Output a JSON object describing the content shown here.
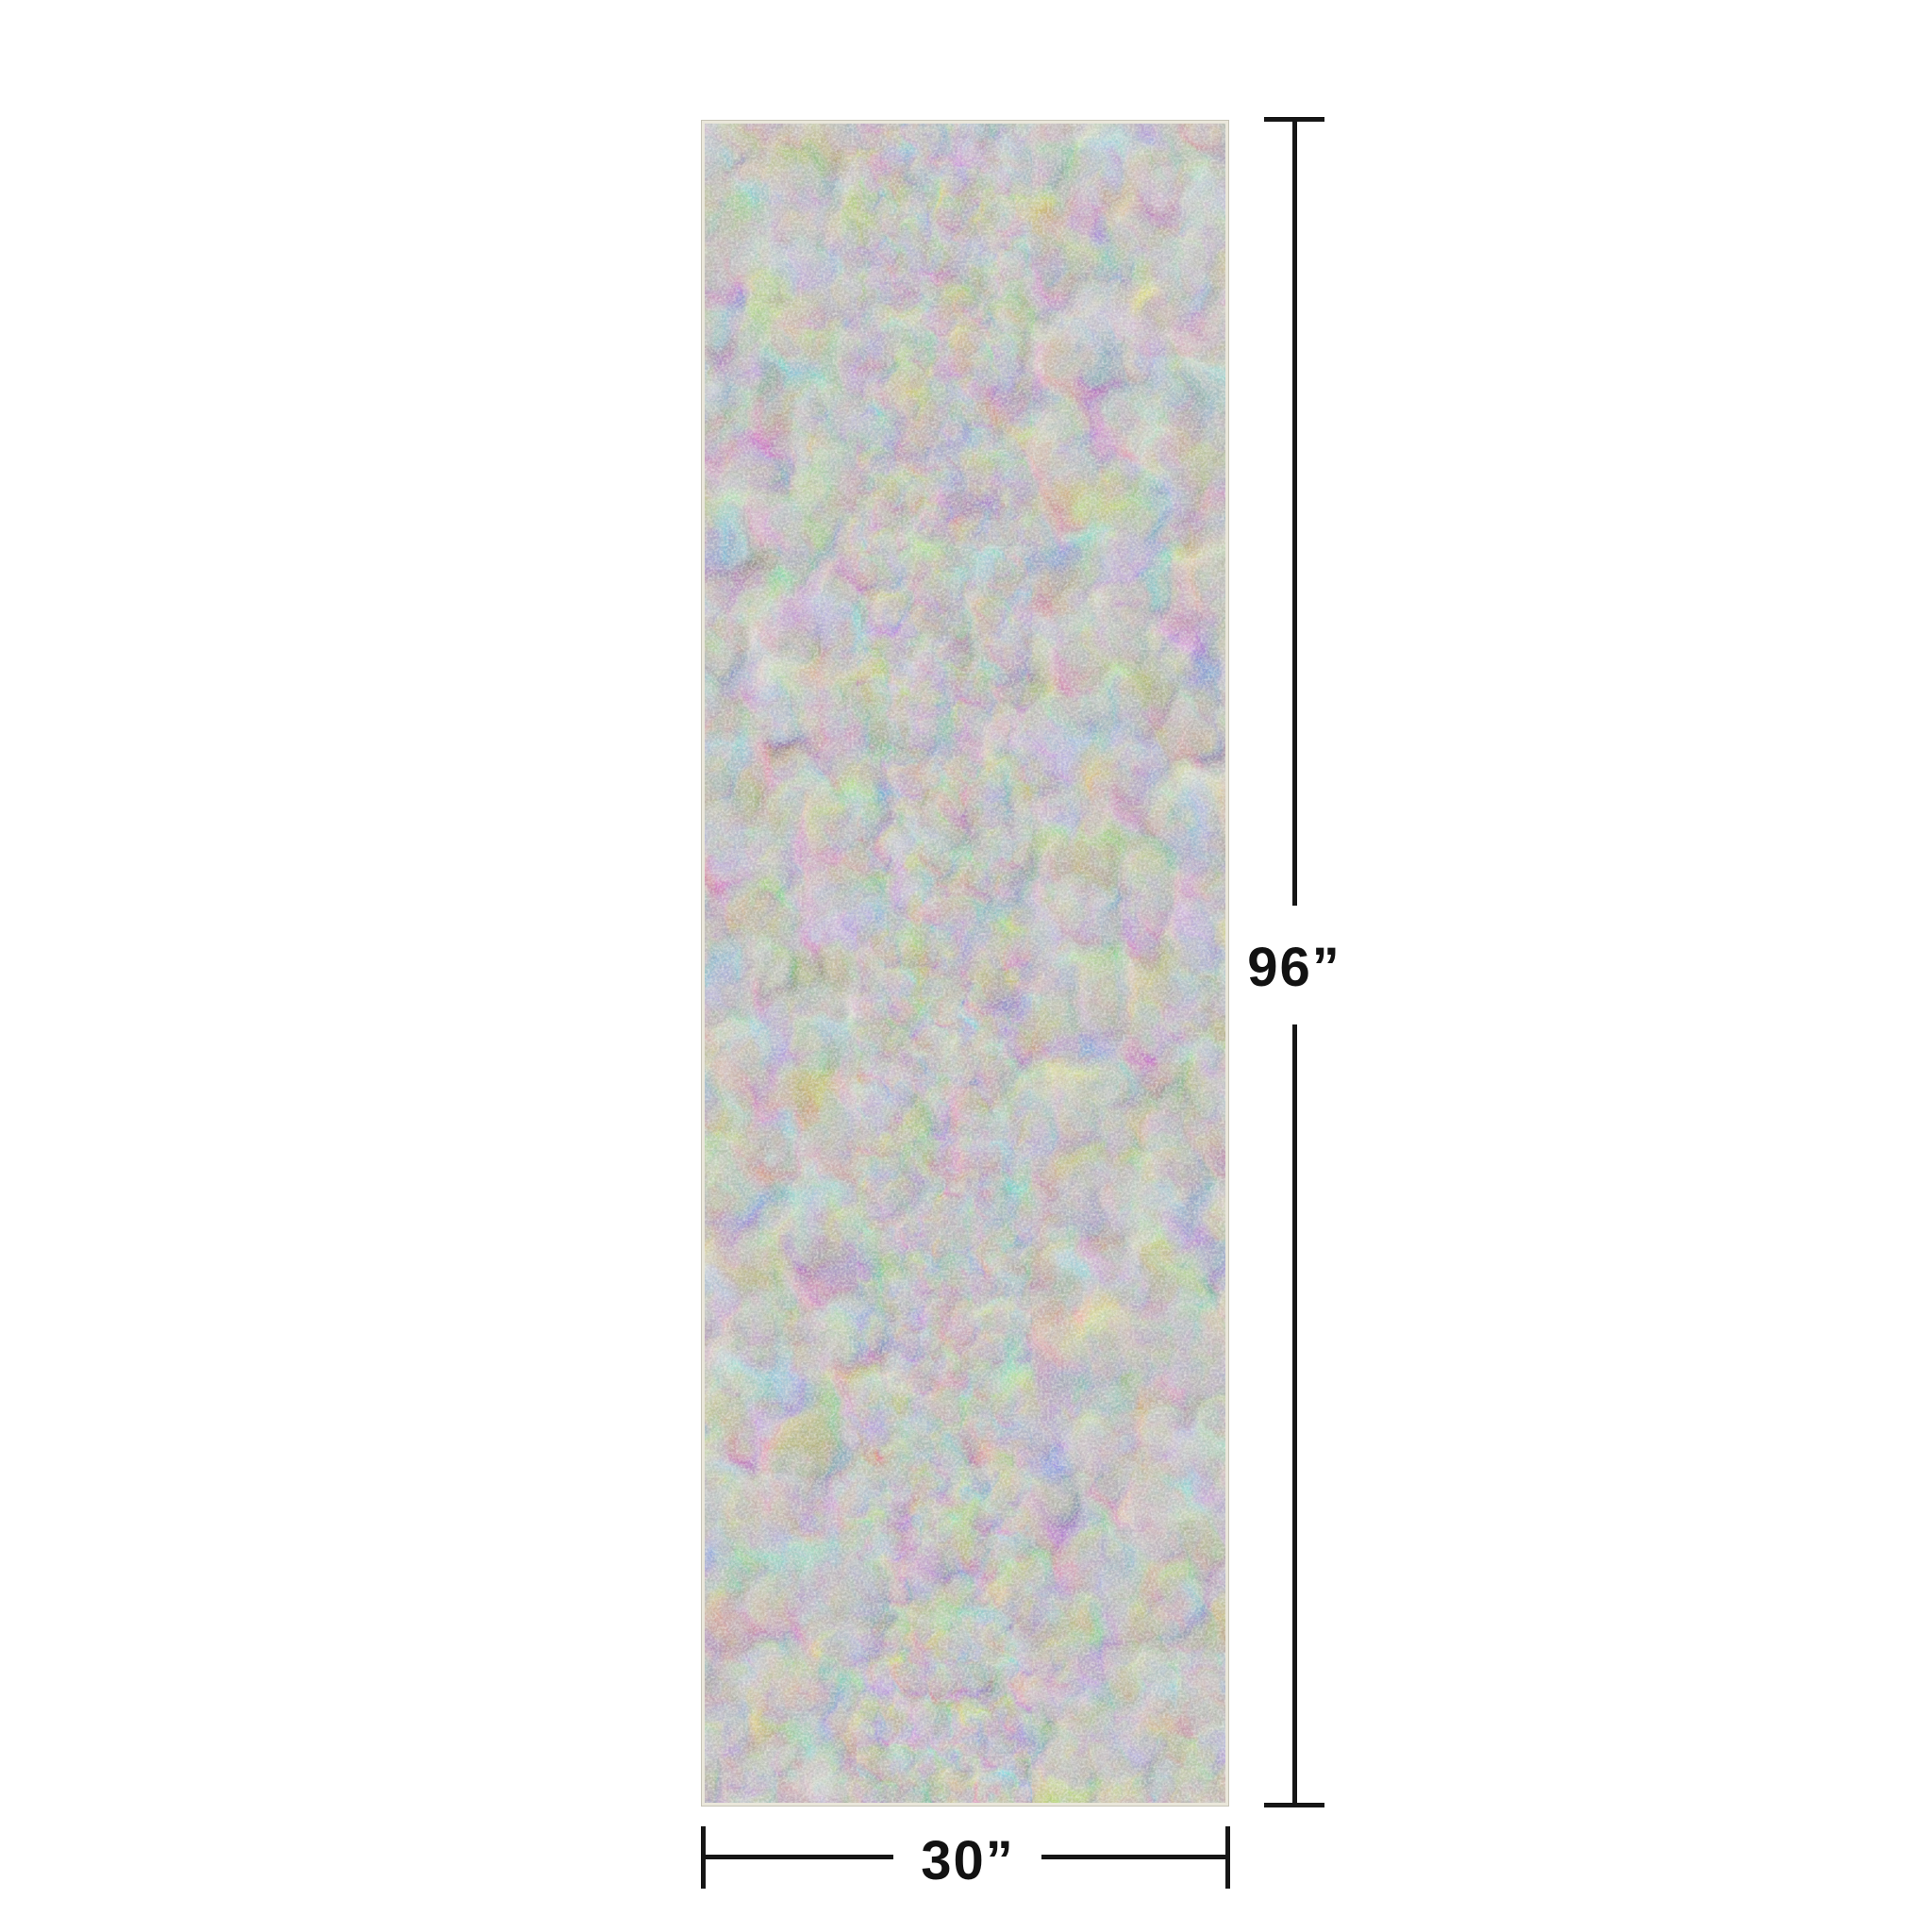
{
  "page": {
    "background_color": "#ffffff",
    "kind": "product-dimension-diagram"
  },
  "rug": {
    "name": "vintage-distressed-runner-rug",
    "alt": "Ivory, beige and gray-blue distressed vintage-style runner rug shown flat",
    "palette": {
      "base_beige": "#dad5cb",
      "light_ivory": "#e9e5dd",
      "blue_gray": "#8ba0b2",
      "slate_gray": "#7e8e9a",
      "tan_accent": "#c6b49c",
      "edge_binding": "#eae7db"
    }
  },
  "dimensions": {
    "line_color": "#161616",
    "height": {
      "label": "96”"
    },
    "width": {
      "label": "30”"
    }
  }
}
